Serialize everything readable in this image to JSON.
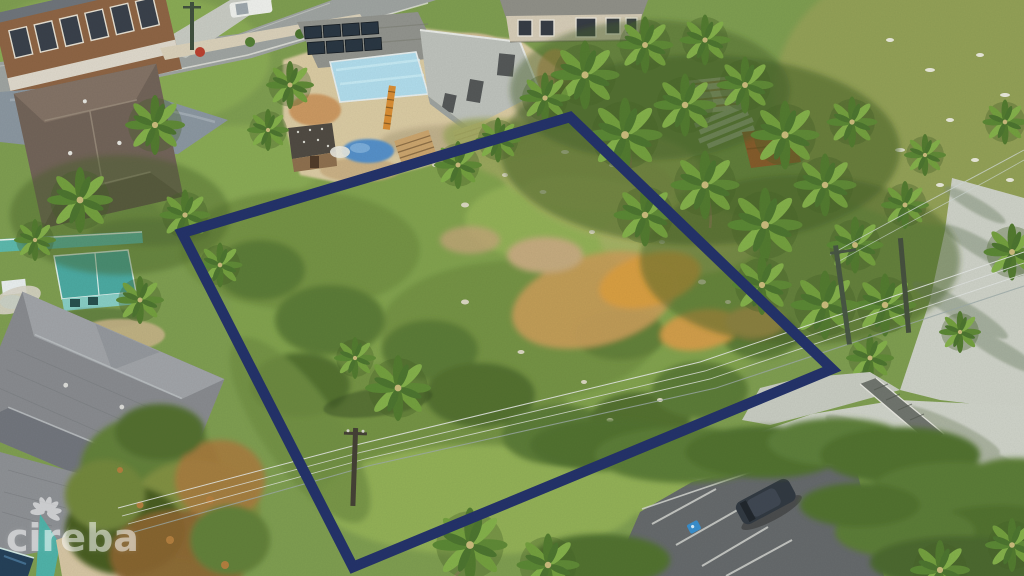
{
  "image": {
    "type": "aerial-drone-photograph",
    "description": "Aerial drone view of a vacant residential land parcel outlined with a navy blue boundary, surrounded by houses, coconut palms, a house under construction and a beachside parking lot",
    "boundary_color": "#1c2b66"
  },
  "lot": {
    "outline_points": "570,117 832,369 353,567 182,233",
    "outline_color": "#1c2b66",
    "outline_width_px": 10.5
  },
  "watermark": {
    "text": "cireba",
    "logo_icon": "petal-flower-icon",
    "color": "#ffffff",
    "opacity": 0.52
  },
  "palette": {
    "vegetation_green": "#7a9a4c",
    "dark_shrub": "#567730",
    "dry_grass": "#aab065",
    "sand": "#d9c9a2",
    "dirt_orange": "#d99b3c",
    "asphalt": "#606468",
    "concrete": "#cdd1c9",
    "roof_gray": "#85888f",
    "roof_brown": "#6d5e55",
    "teal_accent": "#49b0a8",
    "pool_blue": "#1d3a55",
    "tarp_blue": "#4f8cc9",
    "solar_panel": "#222f3e",
    "red_roof": "#cc4e2c"
  },
  "scene_objects": [
    "vacant lot parcel outlined in navy",
    "residential street (top left)",
    "brown two-storey house (top left corner)",
    "brown hip-roof house beside street",
    "white pickup truck parked on street",
    "house under construction with rooftop solar panels and pale blue flat roof",
    "orange ladder, lumber stacks and blue tarp at construction yard",
    "small wooden shed",
    "beige house (top edge)",
    "rusty-roof shack and white lumber (upper right)",
    "red-roof structure among palms",
    "grassy field (top right)",
    "dense coconut palm grove (right side)",
    "teal cottage and teal fence (left)",
    "large gray hip-roof house (bottom left)",
    "swimming pool, teal slide and sandy patio (bottom left corner)",
    "large green-orange tree (bottom left)",
    "overhead power lines with utility poles crossing the lot",
    "beach parking lot with white stall markings (bottom right)",
    "parked dark car",
    "blue accessible-parking road marking",
    "concrete beach-access walkway with palm shadows"
  ]
}
